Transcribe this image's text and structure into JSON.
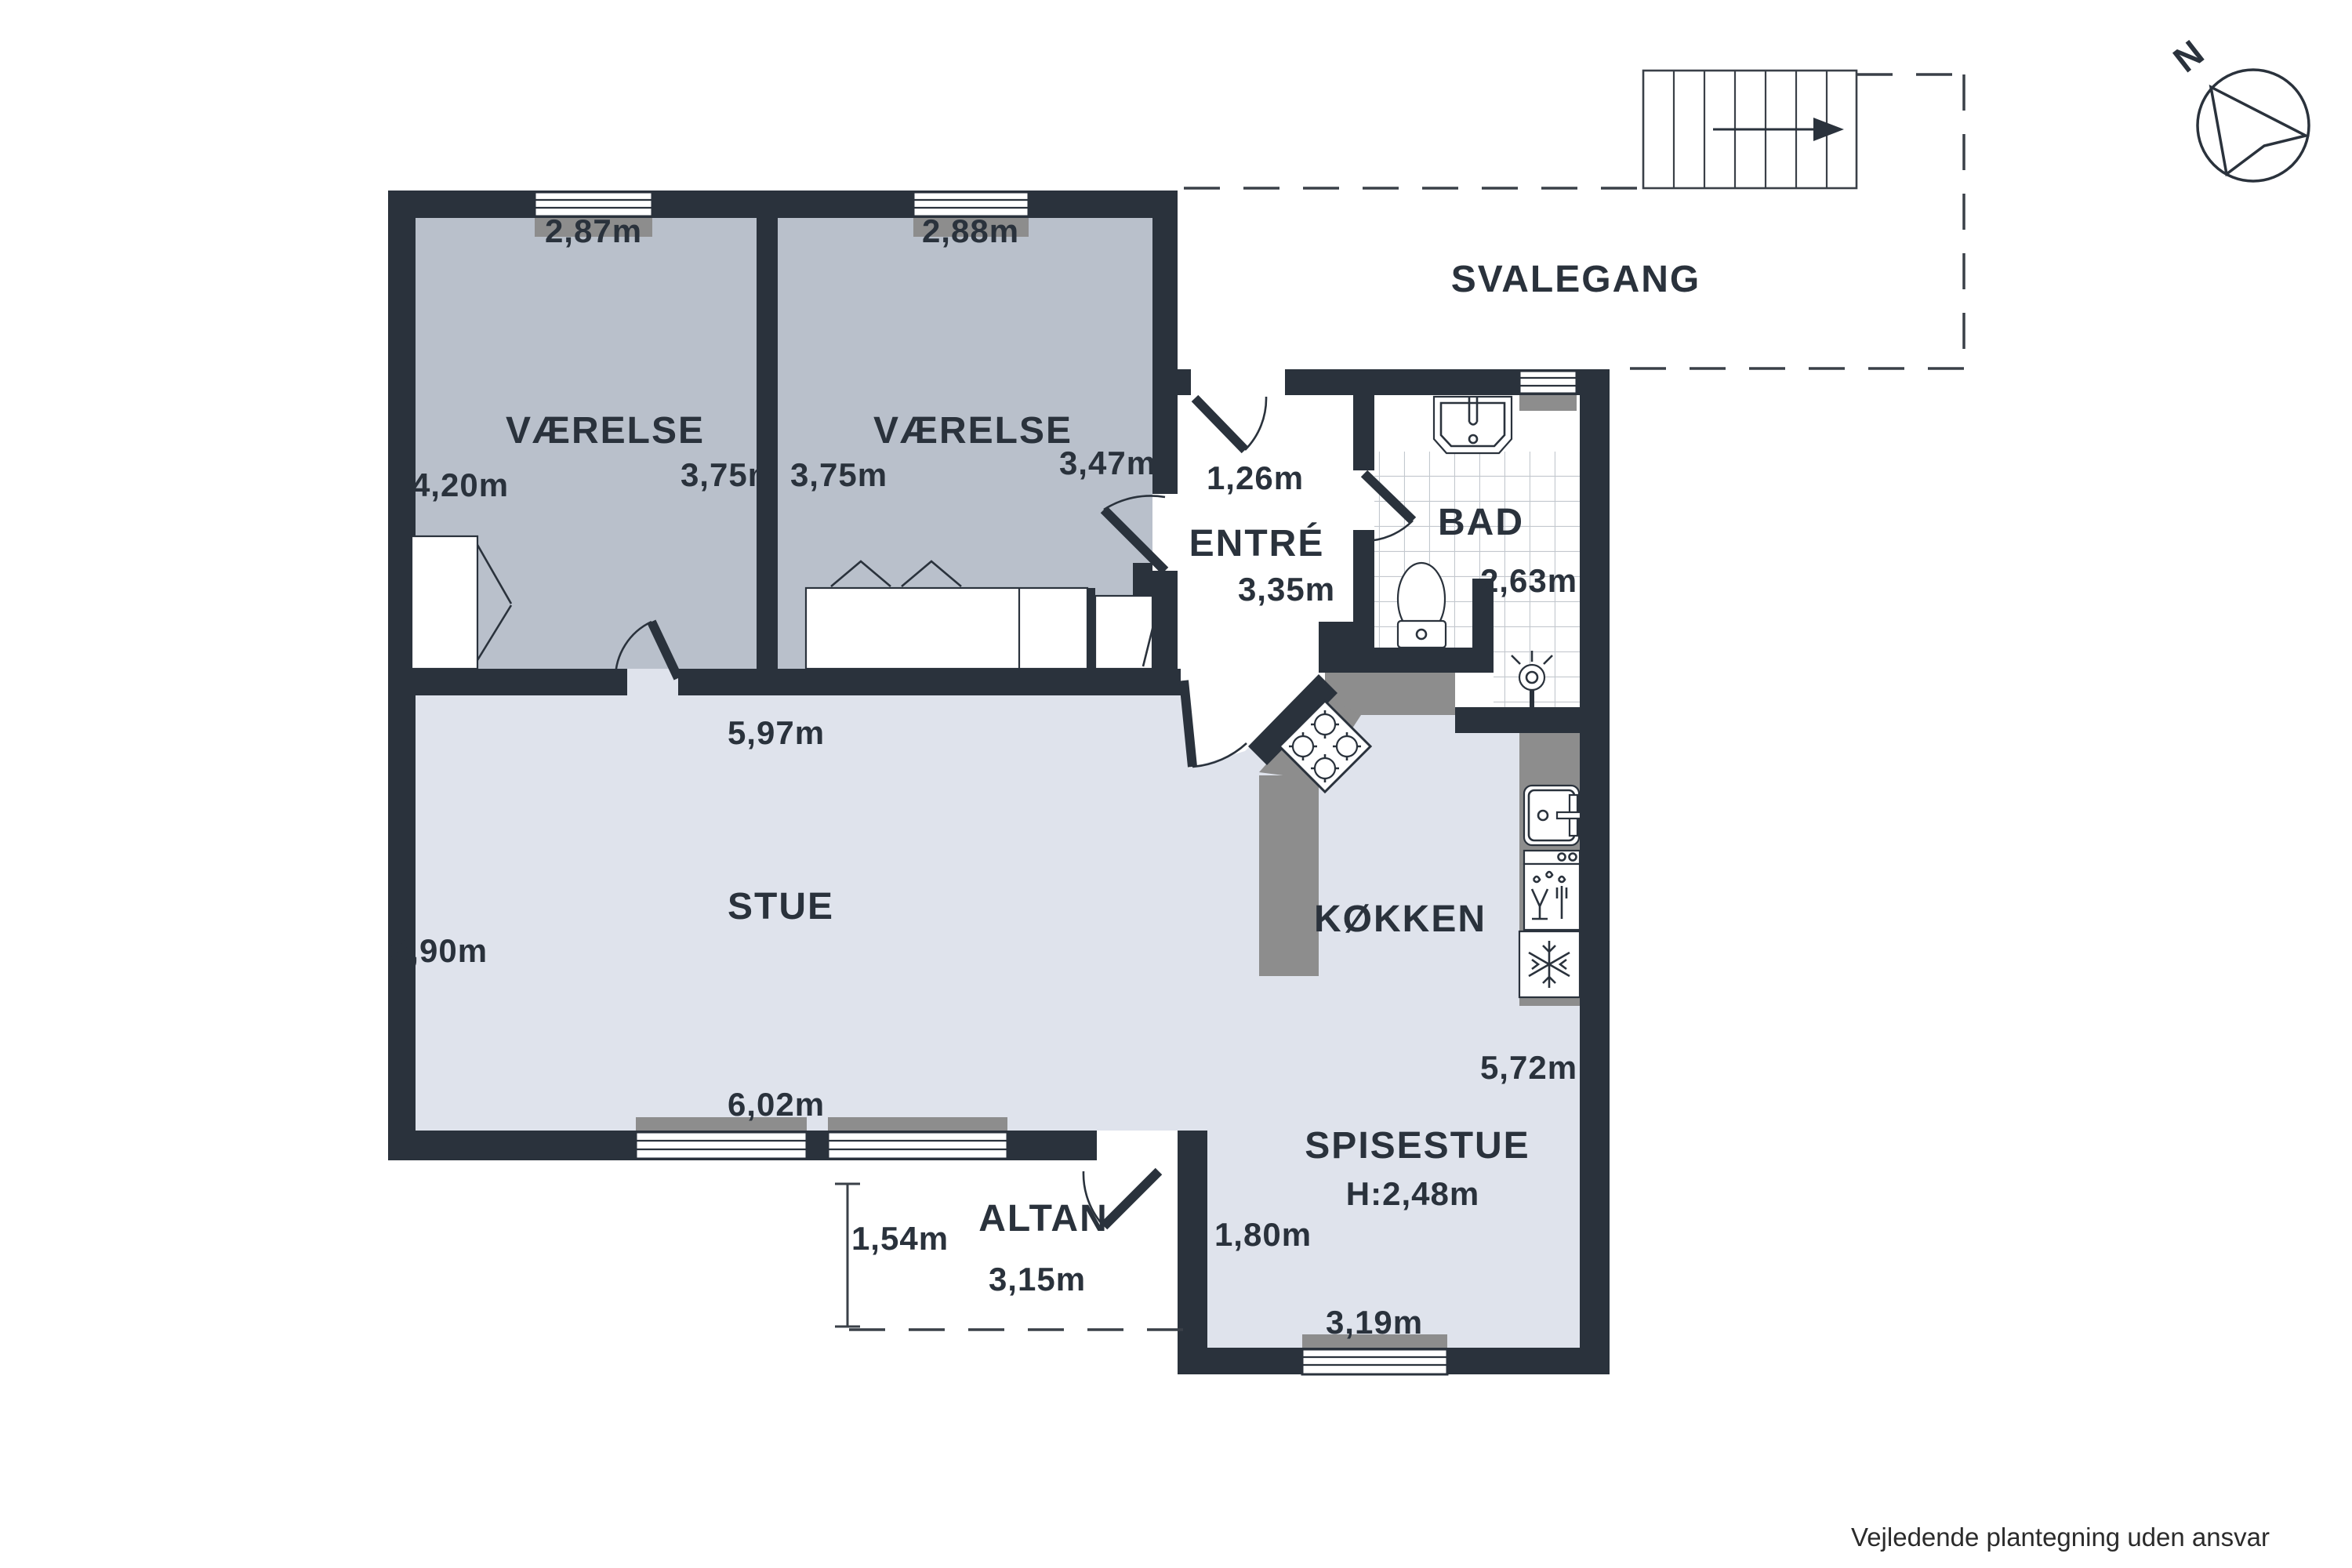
{
  "plan": {
    "compass": {
      "north_label": "N"
    },
    "disclaimer": "Vejledende plantegning uden ansvar",
    "outdoor": {
      "svalegang": {
        "name": "SVALEGANG"
      },
      "altan": {
        "name": "ALTAN",
        "dim_depth": "1,54m",
        "dim_width": "3,15m"
      }
    },
    "rooms": {
      "bedroom1": {
        "name": "VÆRELSE",
        "dim_top": "2,87m",
        "dim_left": "4,20m",
        "dim_right": "3,75m"
      },
      "bedroom2": {
        "name": "VÆRELSE",
        "dim_top": "2,88m",
        "dim_left": "3,75m",
        "dim_right": "3,47m"
      },
      "entre": {
        "name": "ENTRÉ",
        "dim_door": "1,26m",
        "dim_depth": "3,35m"
      },
      "bad": {
        "name": "BAD",
        "dim_width": "2,63m"
      },
      "stue": {
        "name": "STUE",
        "dim_top": "5,97m",
        "dim_left": "3,90m",
        "dim_bottom": "6,02m"
      },
      "kokken": {
        "name": "KØKKEN",
        "dim_right": "5,72m"
      },
      "spisestue": {
        "name": "SPISESTUE",
        "ceiling_height": "H:2,48m",
        "dim_left": "1,80m",
        "dim_bottom": "3,19m"
      }
    },
    "colors": {
      "wall": "#2a323c",
      "bedroom_floor": "#b9c0cb",
      "living_floor": "#dfe3ec",
      "counter": "#8d8d8d",
      "text": "#2a323c"
    }
  }
}
